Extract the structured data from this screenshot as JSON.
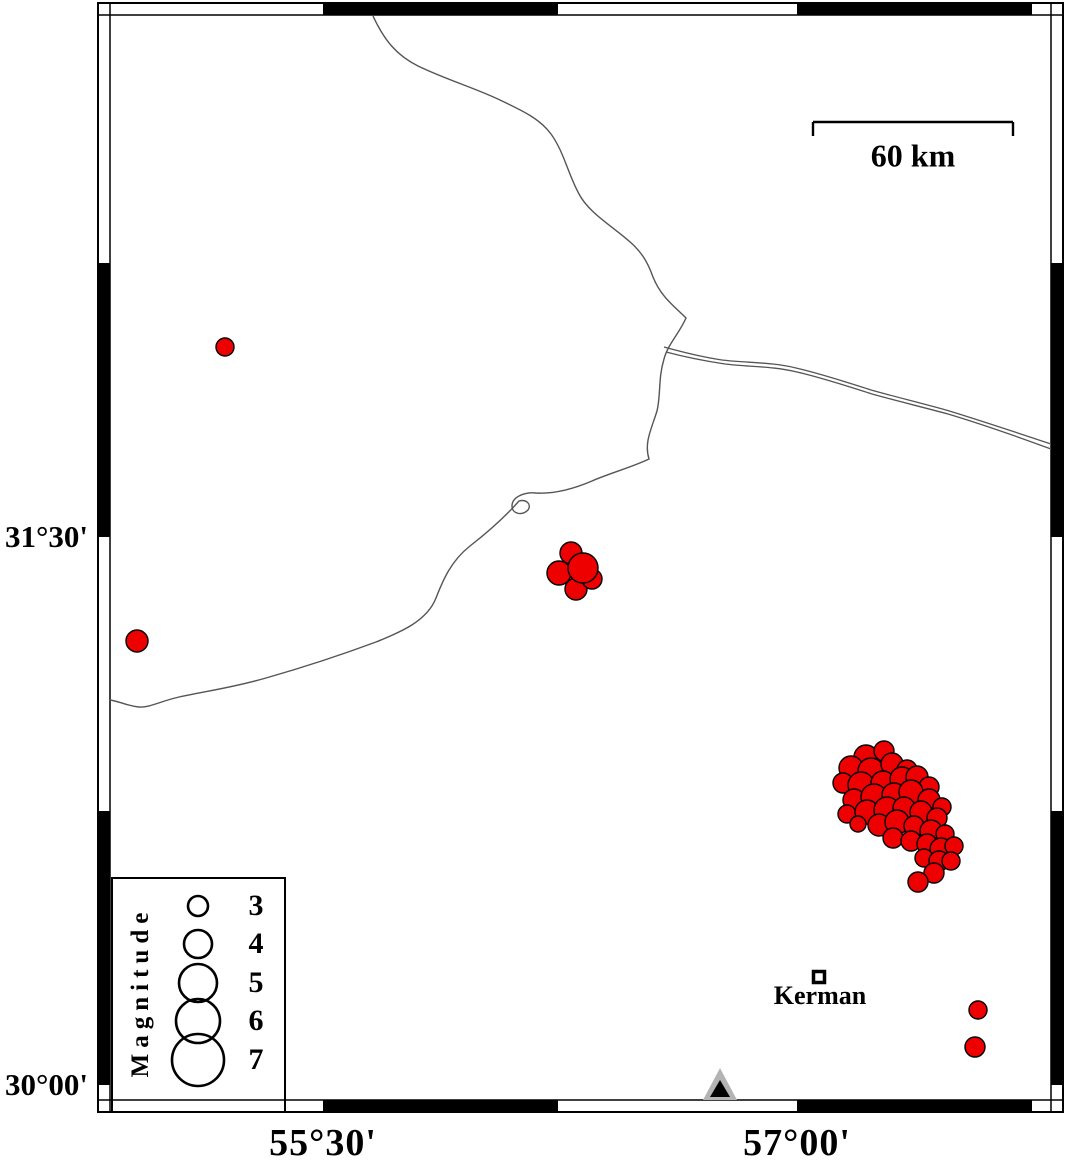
{
  "colors": {
    "earthquake_fill": "#ee0000",
    "outline": "#000000",
    "road_line": "#555555",
    "station_gray": "#b4b4b4",
    "frame_black": "#000000",
    "background": "#ffffff"
  },
  "axes": {
    "left": [
      {
        "label": "31°30'",
        "x": 88,
        "y": 537
      },
      {
        "label": "30°00'",
        "x": 88,
        "y": 1085
      }
    ],
    "bottom": [
      {
        "label": "55°30'",
        "x": 323,
        "y": 1143
      },
      {
        "label": "57°00'",
        "x": 797,
        "y": 1143
      }
    ]
  },
  "frame": {
    "outer": [
      98,
      3,
      1063,
      1112
    ],
    "inner": [
      110,
      15,
      1051,
      1100
    ],
    "x_black_segments": [
      [
        323,
        558
      ],
      [
        797,
        1032
      ]
    ],
    "y_black_segments": [
      [
        263,
        537
      ],
      [
        811,
        1085
      ]
    ]
  },
  "scalebar": {
    "label": "60 km",
    "x1": 813,
    "x2": 1013,
    "y": 122,
    "tick_len": 14,
    "label_x": 913,
    "label_y": 156
  },
  "city": {
    "name": "Kerman",
    "x": 819,
    "y": 977,
    "size": 11,
    "label_x": 820,
    "label_y": 996
  },
  "station": {
    "outer_points": "703,1100 737,1100 720,1068",
    "inner_points": "710,1097 730,1097 720,1080"
  },
  "legend": {
    "title": "Magnitude",
    "box": [
      112,
      878,
      173,
      234
    ],
    "title_x": 141,
    "title_y": 992,
    "circle_cx": 198,
    "num_x": 256,
    "entries": [
      {
        "label": "3",
        "cy": 906,
        "r": 10
      },
      {
        "label": "4",
        "cy": 944,
        "r": 14
      },
      {
        "label": "5",
        "cy": 983,
        "r": 19
      },
      {
        "label": "6",
        "cy": 1021,
        "r": 22
      },
      {
        "label": "7",
        "cy": 1060,
        "r": 26
      }
    ]
  },
  "roads": {
    "main_line": "M 373 16 C 385 42 398 56 418 66 C 447 80 478 89 502 101 C 523 111 540 119 551 134 C 564 152 568 174 579 194 C 589 213 612 226 629 241 C 642 252 648 263 653 277 C 661 297 674 306 686 318 C 679 334 668 344 664 359 C 658 379 661 394 657 411 C 651 430 644 443 649 459 C 630 468 610 473 592 481 C 571 490 553 494 536 493 C 524 492 512 497 512 506 C 512 514 522 516 528 510 C 532 504 526 499 519 501 C 505 517 488 532 470 546 C 451 561 443 580 436 598 C 427 621 401 632 376 642 C 341 655 301 668 266 678 C 231 688 206 691 179 697 C 161 701 149 708 139 707 C 127 706 116 700 109 700",
    "double_road_upper": "M 664 347 C 682 352 702 357 722 360 C 747 363 772 362 796 368 C 822 374 846 382 871 390 C 896 397 921 403 946 410 C 976 419 1012 431 1051 444",
    "double_road_lower": "M 666 352 C 685 357 705 361 725 364 C 749 367 773 366 797 372 C 823 378 847 386 872 394 C 897 401 922 407 948 414 C 978 423 1013 435 1051 449"
  },
  "earthquakes": [
    [
      225,
      347,
      9
    ],
    [
      137,
      641,
      11
    ],
    [
      978,
      1010,
      9
    ],
    [
      975,
      1047,
      10
    ],
    [
      571,
      553,
      11
    ],
    [
      559,
      573,
      12
    ],
    [
      576,
      589,
      11
    ],
    [
      592,
      579,
      10
    ],
    [
      583,
      568,
      15
    ],
    [
      866,
      757,
      12
    ],
    [
      884,
      751,
      10
    ],
    [
      851,
      768,
      12
    ],
    [
      871,
      771,
      13
    ],
    [
      892,
      764,
      11
    ],
    [
      907,
      770,
      10
    ],
    [
      843,
      783,
      10
    ],
    [
      861,
      785,
      13
    ],
    [
      883,
      783,
      12
    ],
    [
      902,
      779,
      12
    ],
    [
      917,
      777,
      11
    ],
    [
      929,
      787,
      10
    ],
    [
      854,
      800,
      11
    ],
    [
      874,
      797,
      13
    ],
    [
      894,
      795,
      12
    ],
    [
      911,
      792,
      12
    ],
    [
      929,
      800,
      11
    ],
    [
      942,
      807,
      9
    ],
    [
      847,
      814,
      9
    ],
    [
      867,
      812,
      12
    ],
    [
      887,
      810,
      13
    ],
    [
      904,
      808,
      11
    ],
    [
      921,
      812,
      11
    ],
    [
      937,
      818,
      10
    ],
    [
      858,
      824,
      8
    ],
    [
      879,
      825,
      11
    ],
    [
      897,
      822,
      12
    ],
    [
      914,
      826,
      10
    ],
    [
      931,
      831,
      11
    ],
    [
      945,
      834,
      9
    ],
    [
      893,
      838,
      10
    ],
    [
      911,
      841,
      10
    ],
    [
      927,
      844,
      10
    ],
    [
      941,
      849,
      11
    ],
    [
      954,
      846,
      9
    ],
    [
      924,
      858,
      9
    ],
    [
      939,
      861,
      10
    ],
    [
      951,
      861,
      9
    ],
    [
      934,
      873,
      10
    ],
    [
      918,
      882,
      10
    ]
  ]
}
